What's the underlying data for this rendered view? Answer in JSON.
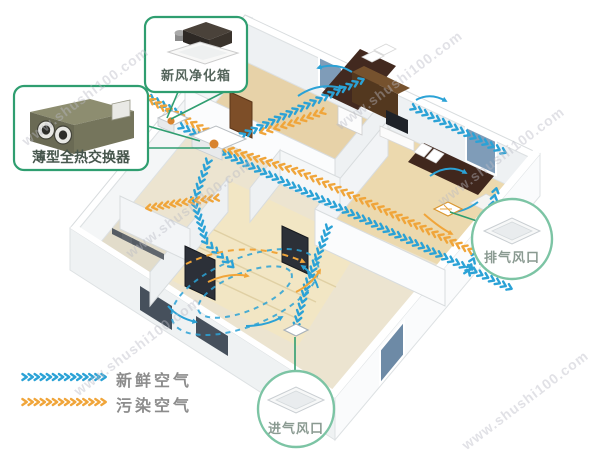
{
  "watermark": {
    "text": "www.shushi100.com"
  },
  "callouts": {
    "purifier": {
      "label": "新风净化箱"
    },
    "exchanger": {
      "label": "薄型全热交换器"
    },
    "exhaust_vent": {
      "label": "排气风口"
    },
    "intake_vent": {
      "label": "进气风口"
    }
  },
  "legend": {
    "fresh_air": {
      "label": "新鲜空气",
      "color": "#2ba2d6"
    },
    "polluted_air": {
      "label": "污染空气",
      "color": "#f0a53a"
    }
  },
  "colors": {
    "callout_border": "#2f9e70",
    "circle_border": "#7cc4a4",
    "fresh_blue": "#2ba2d6",
    "polluted_orange": "#f0a53a"
  }
}
